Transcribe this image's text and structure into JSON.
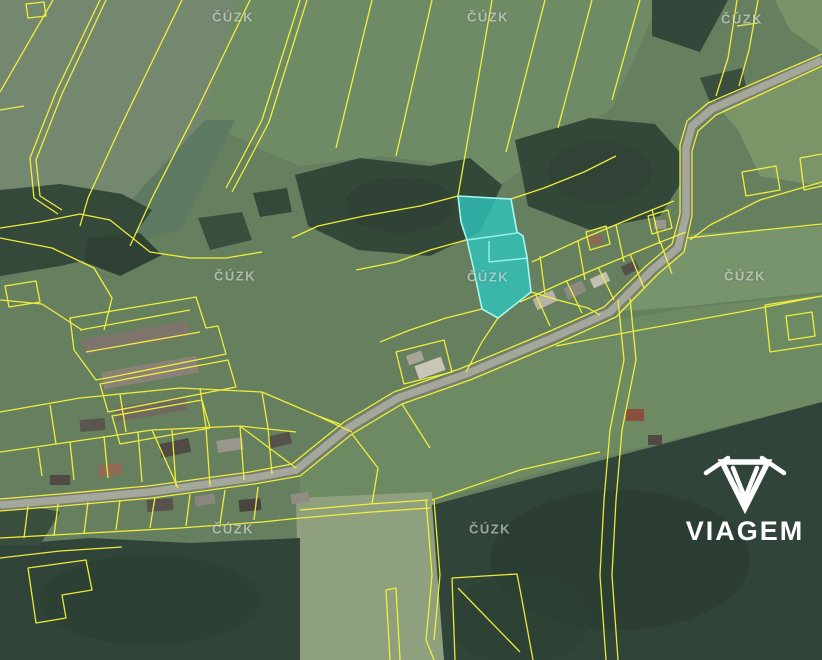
{
  "map": {
    "watermark": "ČÚZK",
    "kind": "cadastral-aerial-map",
    "boundary_color": "#f7f33b",
    "highlighted_parcel": {
      "fill_color": "#2fc6bf",
      "border_color": "#a5f6ef"
    }
  },
  "branding": {
    "logo_text": "VIAGEM",
    "logo_icon": "viagem-shield-icon",
    "logo_color": "#ffffff"
  }
}
